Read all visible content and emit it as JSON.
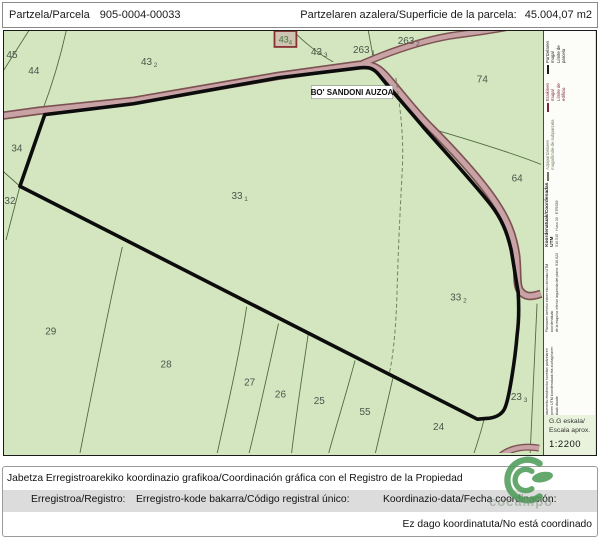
{
  "header": {
    "parcel_label": "Partzela/Parcela",
    "parcel_id": "905-0004-00033",
    "area_label": "Partzelaren azalera/Superficie de la parcela:",
    "area_value": "45.004,07 m2"
  },
  "map": {
    "road_name": "BO' SANDONI AUZOA",
    "building_label": "43",
    "building_sub": "4",
    "parcels": [
      {
        "label": "45",
        "sub": "",
        "x": 8,
        "y": 27
      },
      {
        "label": "44",
        "sub": "",
        "x": 30,
        "y": 43
      },
      {
        "label": "43",
        "sub": "2",
        "x": 146,
        "y": 34
      },
      {
        "label": "43",
        "sub": "3",
        "x": 317,
        "y": 24
      },
      {
        "label": "263",
        "sub": "1",
        "x": 362,
        "y": 22
      },
      {
        "label": "263",
        "sub": "2",
        "x": 407,
        "y": 13
      },
      {
        "label": "74",
        "sub": "",
        "x": 481,
        "y": 52
      },
      {
        "label": "64",
        "sub": "",
        "x": 516,
        "y": 151
      },
      {
        "label": "34",
        "sub": "",
        "x": 13,
        "y": 121
      },
      {
        "label": "32",
        "sub": "",
        "x": 6,
        "y": 174
      },
      {
        "label": "33",
        "sub": "1",
        "x": 237,
        "y": 169
      },
      {
        "label": "33",
        "sub": "2",
        "x": 457,
        "y": 271
      },
      {
        "label": "29",
        "sub": "",
        "x": 47,
        "y": 305
      },
      {
        "label": "28",
        "sub": "",
        "x": 163,
        "y": 338
      },
      {
        "label": "27",
        "sub": "",
        "x": 247,
        "y": 356
      },
      {
        "label": "26",
        "sub": "",
        "x": 278,
        "y": 368
      },
      {
        "label": "25",
        "sub": "",
        "x": 317,
        "y": 375
      },
      {
        "label": "55",
        "sub": "",
        "x": 363,
        "y": 386
      },
      {
        "label": "24",
        "sub": "",
        "x": 437,
        "y": 401
      },
      {
        "label": "23",
        "sub": "3",
        "x": 518,
        "y": 371
      }
    ]
  },
  "legend": {
    "items": [
      {
        "line1": "Partzelaren muga/",
        "line2": "Límite de parcela",
        "color": "#1a1a1a"
      },
      {
        "line1": "Eraikinen muga/",
        "line2": "Límite de edificio",
        "color": "#7a2535"
      },
      {
        "line1": "Azpipartzelaren muga/límite de subparcela",
        "line2": "",
        "color": "#6b7a5a"
      }
    ],
    "coords_title": "Koordenatuak/Coordenadas UTM",
    "coords_sub": "510.515 · Huso 30 · ETRS89",
    "note1_line1": "Planoaren beheko ezkerreko izkinako UTM koordenatuak",
    "note1_line2": "de la esquina inferior izquierda del plano: 510.022 - 4.780.515",
    "note2_line1": "Dokumentu elektroniko honetan partzelaren erpinen UTM koordenatuak eta ziurtagiriaren datuak daude",
    "note2_line2": "Este documento electrónico contiene anexos con las coordenadas UTM de los vértices de la parcela y los datos de la certificación",
    "scale_label_line1": "G.G eskala/",
    "scale_label_line2": "Escala aprox.",
    "scale_value": "1:2200"
  },
  "footer": {
    "coordination_title": "Jabetza Erregistroarekiko koordinazio grafikoa/Coordinación gráfica con el Registro de la Propiedad",
    "registry_label": "Erregistroa/Registro:",
    "registry_code_label": "Erregistro-kode bakarra/Código registral único:",
    "coordination_date_label": "Koordinazio-data/Fecha coordinación:",
    "status": "Ez dago koordinatuta/No está coordinado"
  },
  "watermark": {
    "text": "cocampo"
  },
  "colors": {
    "map_background": "#d3e6bf",
    "road_fill": "#c9a2a6",
    "road_casing": "#7d5252",
    "parcel_boundary": "#0c0c0c",
    "thin_line": "#4e6b3e",
    "watermark_green": "#4f9d5a"
  }
}
